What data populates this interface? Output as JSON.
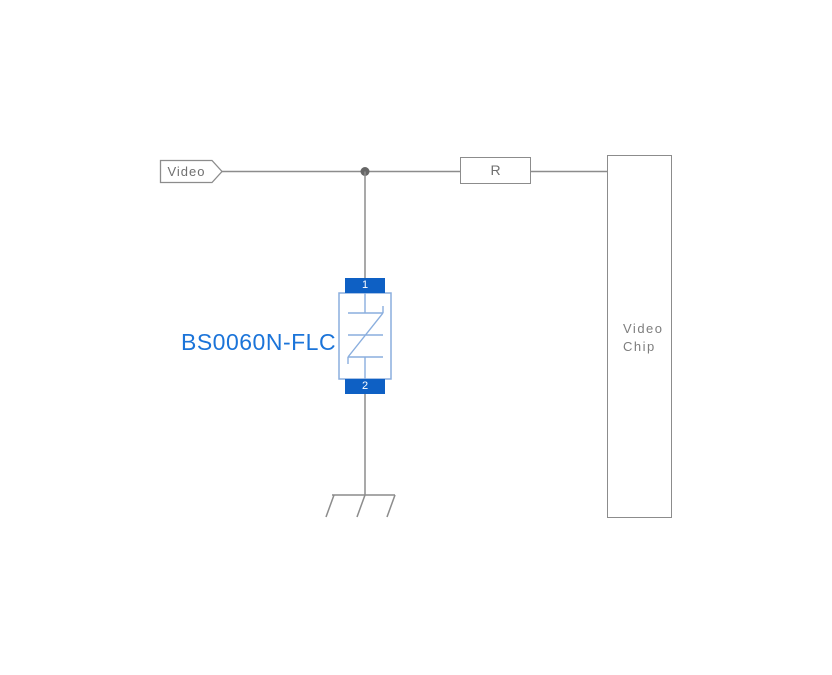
{
  "schematic": {
    "net_tag": {
      "label": "Video"
    },
    "resistor": {
      "label": "R"
    },
    "chip": {
      "label_line1": "Video",
      "label_line2": "Chip"
    },
    "tvs": {
      "part_number": "BS0060N-FLC",
      "pin_top": "1",
      "pin_bottom": "2"
    }
  },
  "colors": {
    "background": "#ffffff",
    "wire_gray": "#8c8c8c",
    "label_gray": "#6f6f6f",
    "junction_gray": "#666666",
    "pin_blue": "#0e60c4",
    "symbol_light_blue": "#8aaede",
    "part_number_blue": "#1b74d9"
  }
}
